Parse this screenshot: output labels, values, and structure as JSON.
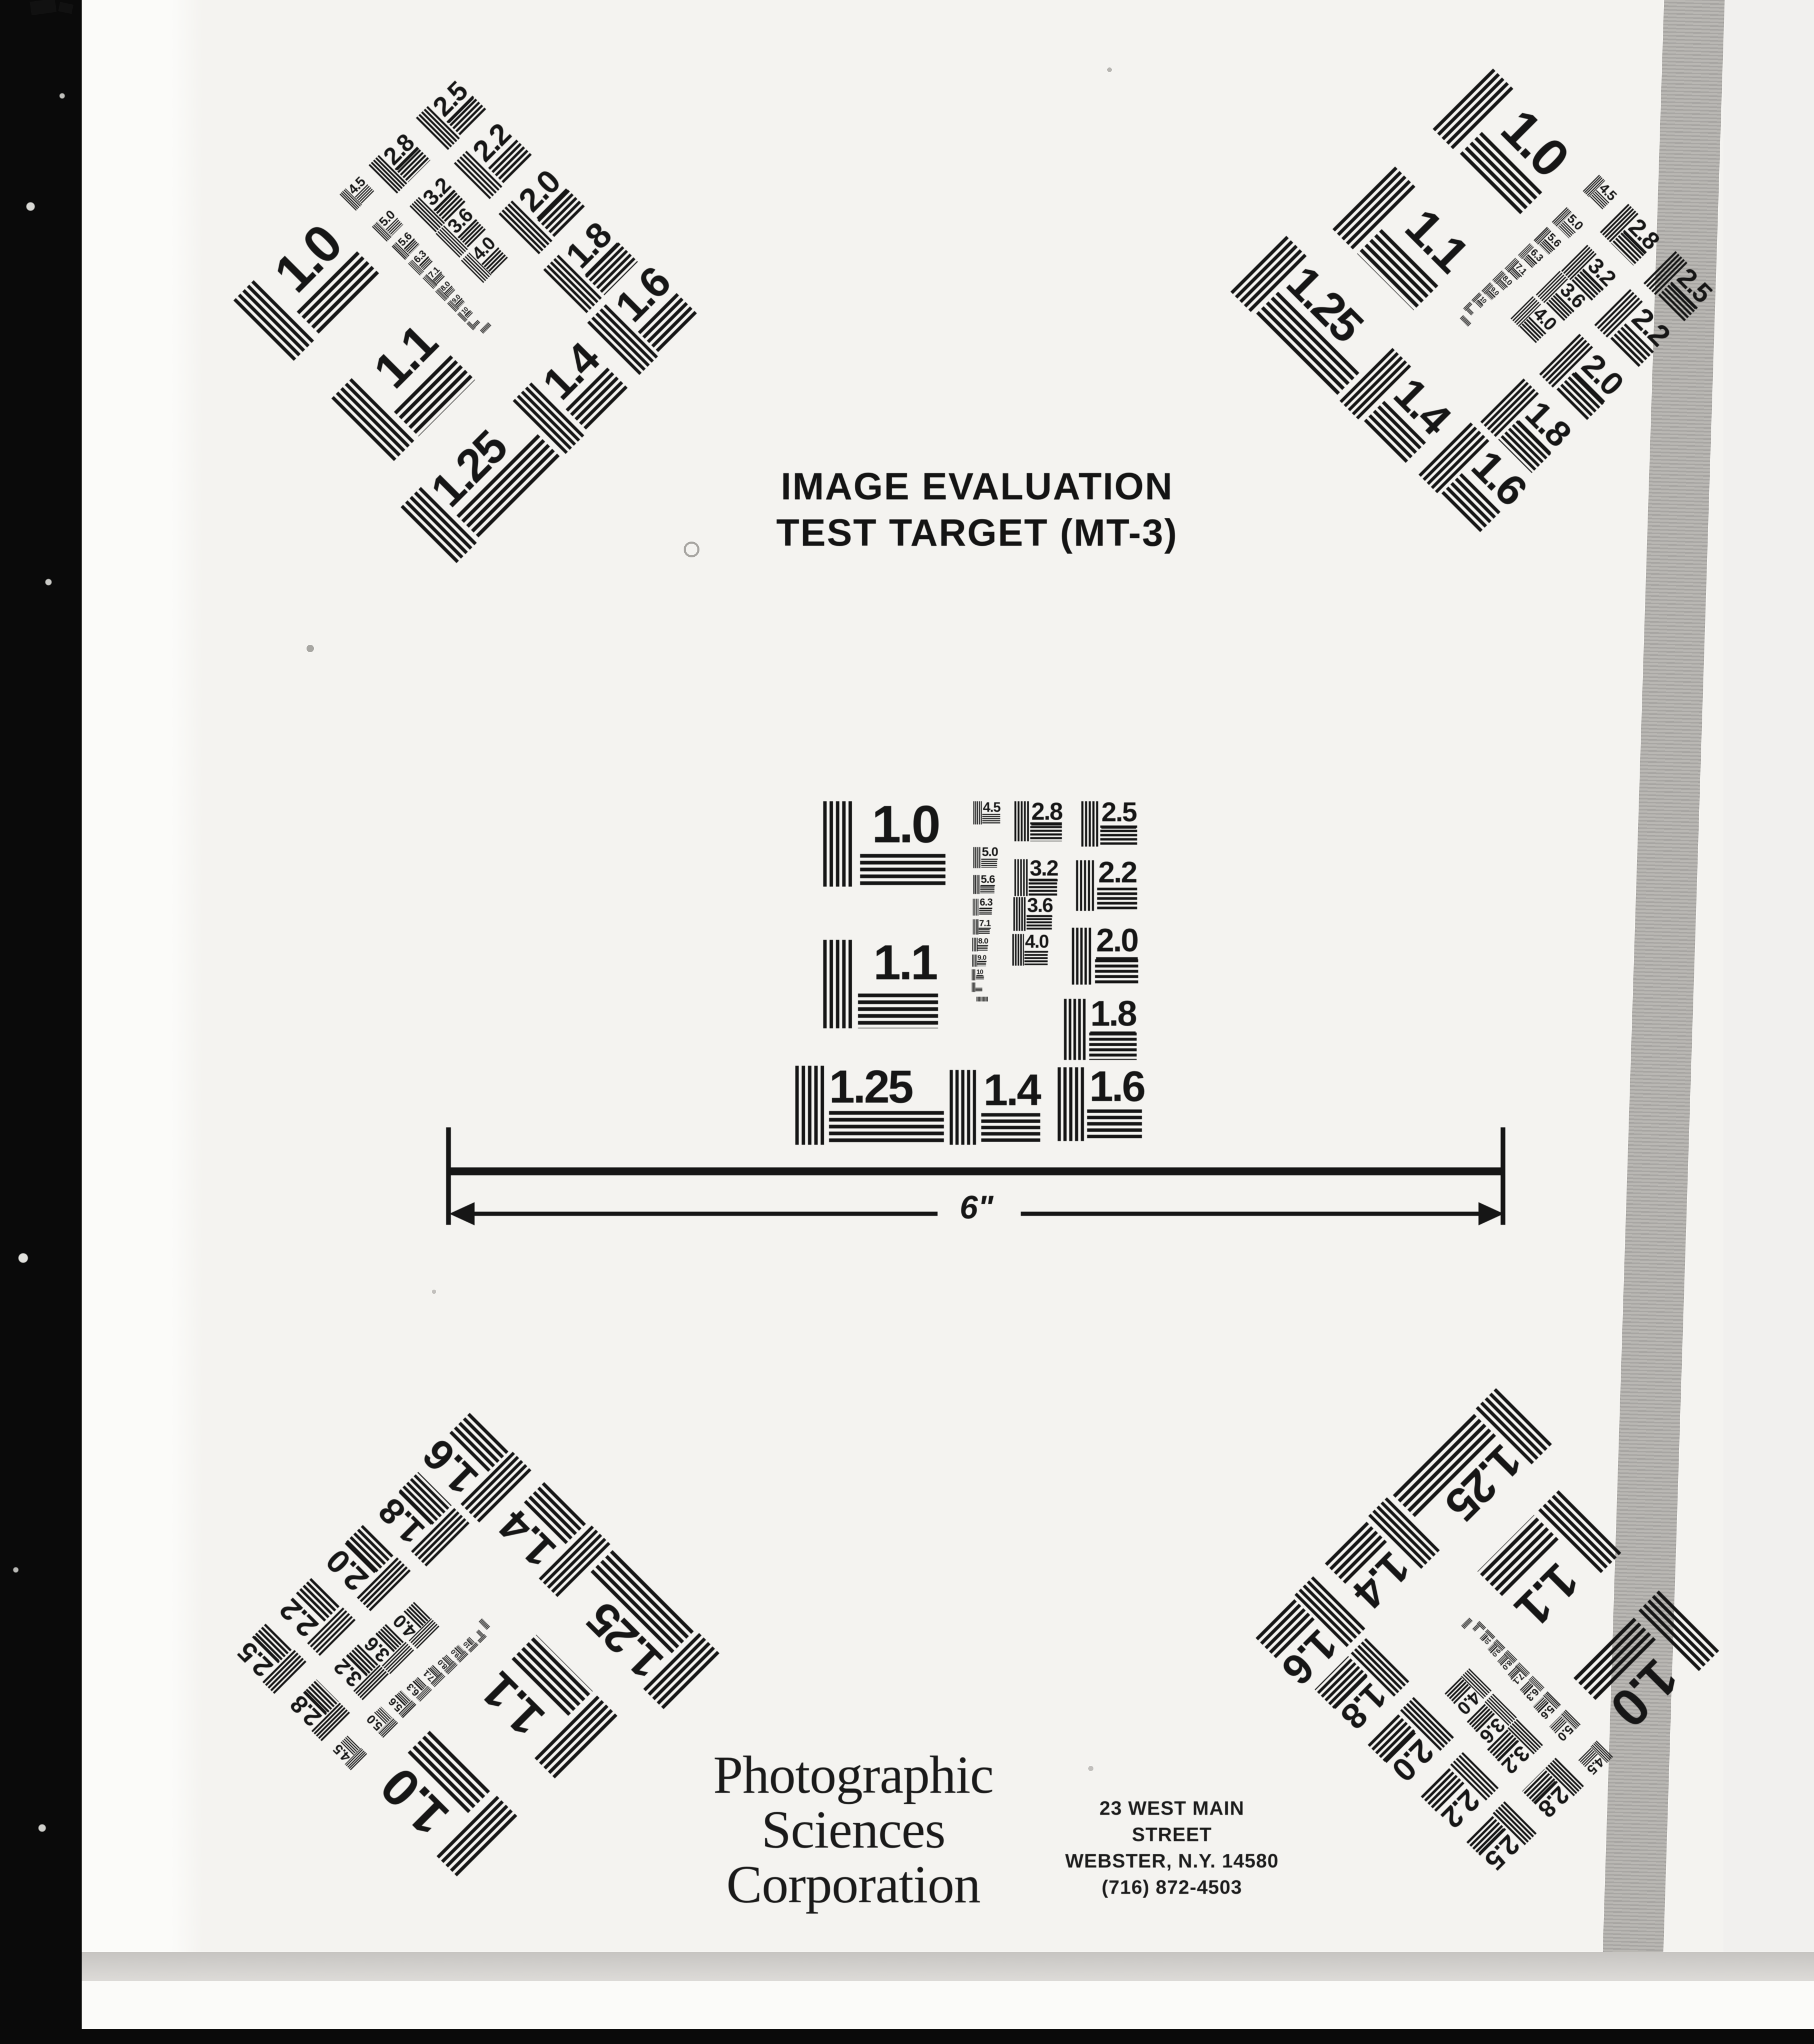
{
  "colors": {
    "ink": "#161616",
    "film": "#0a0a0a",
    "paper": "#f4f3f0",
    "edge_band": "#b5b3af"
  },
  "header": {
    "title_line1": "IMAGE EVALUATION",
    "title_line2": "TEST TARGET (MT-3)"
  },
  "scale_bar": {
    "label": "6\""
  },
  "test_target": {
    "element_labels": [
      "1.0",
      "1.1",
      "1.25",
      "1.4",
      "1.6",
      "2.5",
      "2.2",
      "2.0",
      "1.8",
      "2.8",
      "3.2",
      "3.6",
      "4.0",
      "4.5",
      "5.0",
      "5.6",
      "6.3",
      "7.1",
      "8.0",
      "9.0",
      "10",
      "",
      ""
    ],
    "instances": [
      "top-left",
      "top-right",
      "center",
      "bottom-left",
      "bottom-right"
    ]
  },
  "footer": {
    "company_lines": [
      "Photographic",
      "Sciences",
      "Corporation"
    ],
    "address_lines": [
      "23 WEST MAIN STREET",
      "WEBSTER, N.Y. 14580",
      "(716) 872-4503"
    ]
  }
}
